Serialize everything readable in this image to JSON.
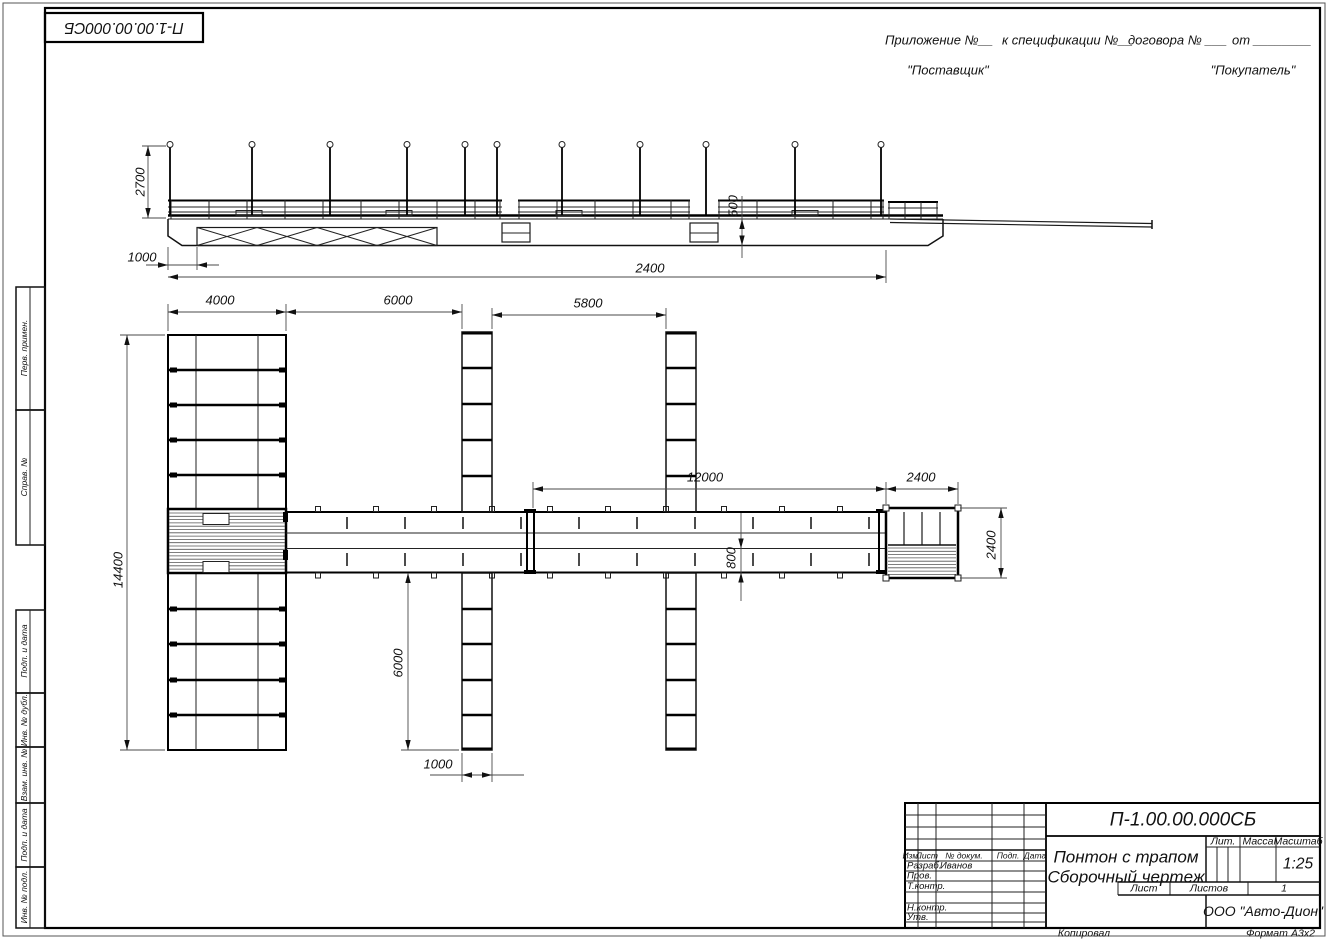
{
  "sheet": {
    "stamp": "П-1.00.00.000СБ",
    "appendix": {
      "p1": "Приложение №__",
      "p2": "к спецификации №__",
      "p3": "договора № ___",
      "p4": "от ________"
    },
    "supplier": "\"Поставщик\"",
    "buyer": "\"Покупатель\"",
    "copied": "Копировал",
    "format_label": "Формат",
    "format_value": "А3х2"
  },
  "margin_boxes": {
    "perv": "Перв. примен.",
    "sprav": "Справ. №",
    "podp1": "Подп. и дата",
    "inv_dubl": "Инв. № дубл.",
    "vzam": "Взам. инв. №",
    "podp2": "Подп. и дата",
    "inv_podl": "Инв. № подл."
  },
  "title_block": {
    "doc_number": "П-1.00.00.000СБ",
    "col_izm": "Изм.",
    "col_list": "Лист",
    "col_docnum": "№ докум.",
    "col_podp": "Подп.",
    "col_data": "Дата",
    "row_razrab": "Разраб.",
    "razrab_name": "Иванов",
    "row_prov": "Пров.",
    "row_tkontr": "Т.контр.",
    "row_nkontr": "Н.контр.",
    "row_utv": "Утв.",
    "title_line1": "Понтон с трапом",
    "title_line2": "Сборочный чертеж",
    "lit_label": "Лит.",
    "mass_label": "Масса",
    "scale_label": "Масштаб",
    "scale_value": "1:25",
    "list_label": "Лист",
    "listov_label": "Листов",
    "listov_value": "1",
    "company": "ООО \"Авто-Дион\""
  },
  "dims": {
    "side_height": "2700",
    "side_offset": "1000",
    "side_overall": "2400",
    "side_freeboard": "500",
    "plan_pontoon_w": "4000",
    "plan_gap1": "6000",
    "plan_gap2": "5800",
    "plan_walkway": "12000",
    "plan_platform_w": "2400",
    "plan_length": "14400",
    "plan_pier_len": "6000",
    "plan_pier_w": "1000",
    "plan_lane": "800",
    "plan_platform_d": "2400"
  }
}
